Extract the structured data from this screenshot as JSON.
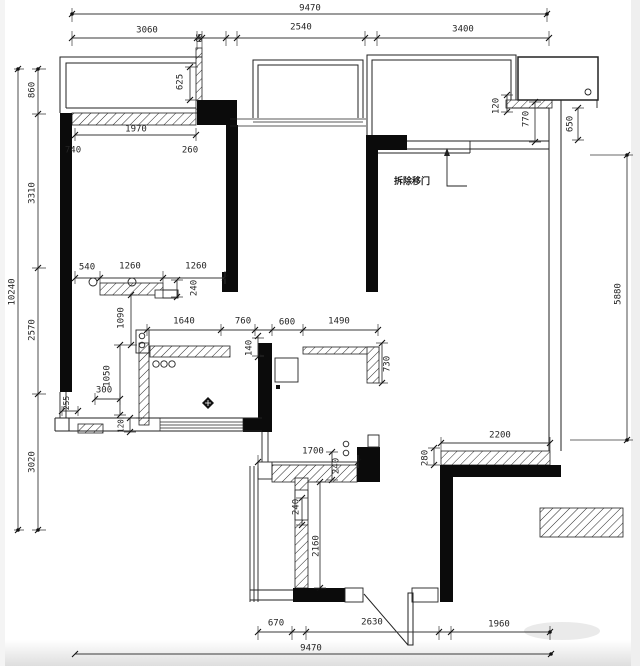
{
  "page": {
    "background": "#ffffff",
    "line_color": "#1c1c1c",
    "wall_fill": "#0b0b0b",
    "text_color": "#242424"
  },
  "annotation": {
    "demolish_door_label": "拆除移门"
  },
  "dimensions": {
    "overall": {
      "width_mm": "9470",
      "height_mm": "10240"
    },
    "chains": {
      "top_segments": [
        "3060",
        "90",
        "2540",
        "3400"
      ],
      "top_total": "9470",
      "left_segments": [
        "860",
        "3310",
        "2570",
        "3020"
      ],
      "left_total": "10240",
      "bottom_segments": [
        "670",
        "2630",
        "1960"
      ],
      "bottom_total": "9470",
      "right_segments": [
        "120",
        "770",
        "650",
        "5880"
      ],
      "interior": [
        "625",
        "1970",
        "740",
        "260",
        "540",
        "1260",
        "1260",
        "240",
        "1090",
        "1640",
        "760",
        "140",
        "600",
        "1490",
        "730",
        "300",
        "255",
        "1050",
        "120",
        "2200",
        "280",
        "1700",
        "240",
        "240",
        "2160"
      ]
    },
    "labels": [
      {
        "id": "t9470",
        "text": "9470",
        "x": 310,
        "y": 9,
        "rot": 0
      },
      {
        "id": "t3060",
        "text": "3060",
        "x": 147,
        "y": 31,
        "rot": 0
      },
      {
        "id": "t90",
        "text": "90",
        "x": 198,
        "y": 38,
        "rot": 90,
        "size": 7.5
      },
      {
        "id": "t2540",
        "text": "2540",
        "x": 301,
        "y": 28,
        "rot": 0
      },
      {
        "id": "t3400",
        "text": "3400",
        "x": 463,
        "y": 30,
        "rot": 0
      },
      {
        "id": "l860",
        "text": "860",
        "x": 33,
        "y": 90,
        "rot": -90
      },
      {
        "id": "l3310",
        "text": "3310",
        "x": 33,
        "y": 193,
        "rot": -90
      },
      {
        "id": "l2570",
        "text": "2570",
        "x": 33,
        "y": 330,
        "rot": -90
      },
      {
        "id": "l3020",
        "text": "3020",
        "x": 33,
        "y": 462,
        "rot": -90
      },
      {
        "id": "l10240",
        "text": "10240",
        "x": 13,
        "y": 292,
        "rot": -90
      },
      {
        "id": "r120",
        "text": "120",
        "x": 497,
        "y": 106,
        "rot": -90
      },
      {
        "id": "r770",
        "text": "770",
        "x": 527,
        "y": 119,
        "rot": -90
      },
      {
        "id": "r650",
        "text": "650",
        "x": 571,
        "y": 124,
        "rot": -90
      },
      {
        "id": "r5880",
        "text": "5880",
        "x": 619,
        "y": 294,
        "rot": -90
      },
      {
        "id": "b625",
        "text": "625",
        "x": 181,
        "y": 82,
        "rot": -90
      },
      {
        "id": "b1970",
        "text": "1970",
        "x": 136,
        "y": 130,
        "rot": 0
      },
      {
        "id": "b740",
        "text": "740",
        "x": 73,
        "y": 151,
        "rot": 0
      },
      {
        "id": "b260",
        "text": "260",
        "x": 190,
        "y": 151,
        "rot": 0
      },
      {
        "id": "b540",
        "text": "540",
        "x": 87,
        "y": 268,
        "rot": 0
      },
      {
        "id": "b1260a",
        "text": "1260",
        "x": 130,
        "y": 267,
        "rot": 0
      },
      {
        "id": "b1260b",
        "text": "1260",
        "x": 196,
        "y": 267,
        "rot": 0
      },
      {
        "id": "b240",
        "text": "240",
        "x": 195,
        "y": 288,
        "rot": -90
      },
      {
        "id": "k1090",
        "text": "1090",
        "x": 122,
        "y": 318,
        "rot": -90
      },
      {
        "id": "c1640",
        "text": "1640",
        "x": 184,
        "y": 322,
        "rot": 0
      },
      {
        "id": "c760",
        "text": "760",
        "x": 243,
        "y": 322,
        "rot": 0
      },
      {
        "id": "c140",
        "text": "140",
        "x": 250,
        "y": 348,
        "rot": -90
      },
      {
        "id": "c600",
        "text": "600",
        "x": 287,
        "y": 323,
        "rot": 0
      },
      {
        "id": "c1490",
        "text": "1490",
        "x": 339,
        "y": 322,
        "rot": 0
      },
      {
        "id": "c730",
        "text": "730",
        "x": 388,
        "y": 364,
        "rot": -90
      },
      {
        "id": "k300",
        "text": "300",
        "x": 104,
        "y": 391,
        "rot": 0
      },
      {
        "id": "k255",
        "text": "255",
        "x": 67,
        "y": 403,
        "rot": -90,
        "size": 8
      },
      {
        "id": "k1050",
        "text": "1050",
        "x": 108,
        "y": 376,
        "rot": -90
      },
      {
        "id": "k120",
        "text": "120",
        "x": 121,
        "y": 426,
        "rot": -90,
        "size": 7.5
      },
      {
        "id": "rb2200",
        "text": "2200",
        "x": 500,
        "y": 436,
        "rot": 0
      },
      {
        "id": "rb280",
        "text": "280",
        "x": 426,
        "y": 458,
        "rot": -90
      },
      {
        "id": "d1700",
        "text": "1700",
        "x": 313,
        "y": 452,
        "rot": 0
      },
      {
        "id": "d240a",
        "text": "240",
        "x": 337,
        "y": 466,
        "rot": -90
      },
      {
        "id": "d240b",
        "text": "240",
        "x": 297,
        "y": 507,
        "rot": -90
      },
      {
        "id": "d2160",
        "text": "2160",
        "x": 317,
        "y": 546,
        "rot": -90
      },
      {
        "id": "bt670",
        "text": "670",
        "x": 276,
        "y": 624,
        "rot": 0
      },
      {
        "id": "bt2630",
        "text": "2630",
        "x": 372,
        "y": 623,
        "rot": 0
      },
      {
        "id": "bt1960",
        "text": "1960",
        "x": 499,
        "y": 625,
        "rot": 0
      },
      {
        "id": "bt9470",
        "text": "9470",
        "x": 311,
        "y": 649,
        "rot": 0
      }
    ]
  }
}
